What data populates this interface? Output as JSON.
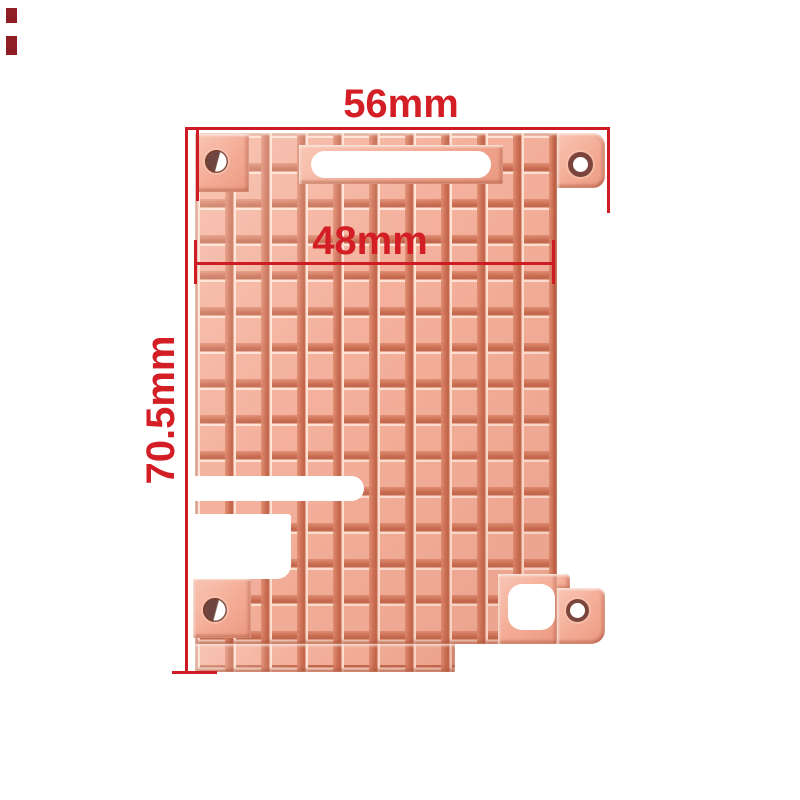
{
  "figure": {
    "type": "product-photo",
    "subject": "Copper heatsink shim plate with waffle pin grid, mounting holes, slot and edge cutouts",
    "background": "#ffffff"
  },
  "annotations": {
    "top_width_label": "56mm",
    "inner_width_label": "48mm",
    "height_label": "70.5mm",
    "dimension_color": "#cd1c24",
    "label_color": "#d31e26"
  },
  "palette": {
    "copper_base": "#f4b19d",
    "copper_highlight": "#ffe4d6",
    "copper_shadow": "#c4684e",
    "hole_dark": "#6e463f"
  }
}
